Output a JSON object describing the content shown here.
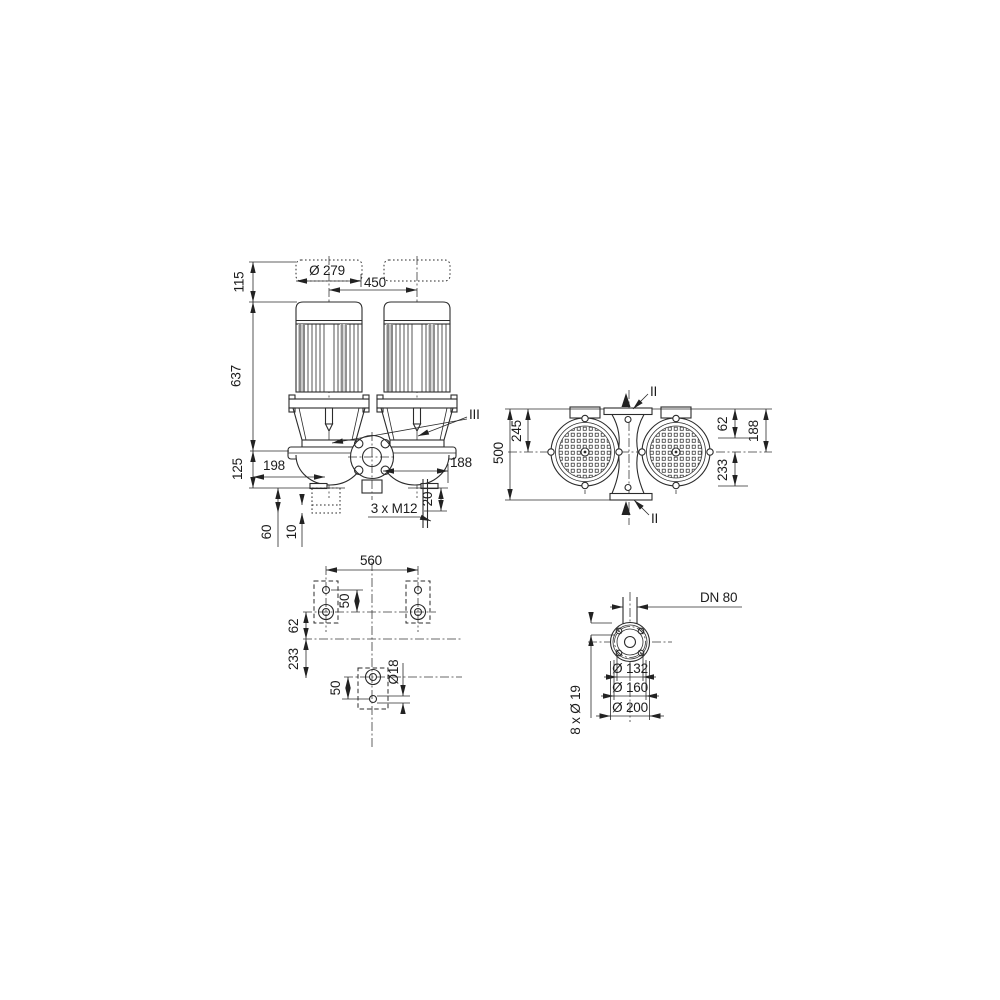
{
  "front_view": {
    "motor_diameter": "Ø 279",
    "motor_spacing": "450",
    "dim_115": "115",
    "dim_637": "637",
    "dim_125": "125",
    "dim_198": "198",
    "dim_188": "188",
    "dim_20": "20",
    "dim_60": "60",
    "dim_10": "10",
    "tapping": "3 x M12",
    "section_label": "III"
  },
  "top_view": {
    "dim_500": "500",
    "dim_245": "245",
    "dim_62": "62",
    "dim_188": "188",
    "dim_233": "233",
    "section_top": "II",
    "section_bottom": "II"
  },
  "foundation_view": {
    "dim_560": "560",
    "dim_50_upper": "50",
    "dim_62": "62",
    "dim_233": "233",
    "dim_50_lower": "50",
    "hole_diameter": "Ø18"
  },
  "flange_view": {
    "nominal_diameter": "DN 80",
    "dia_132": "Ø 132",
    "dia_160": "Ø 160",
    "dia_200": "Ø 200",
    "bolt_holes": "8 x Ø 19"
  },
  "colors": {
    "line": "#2b2b2b",
    "background": "#ffffff"
  }
}
